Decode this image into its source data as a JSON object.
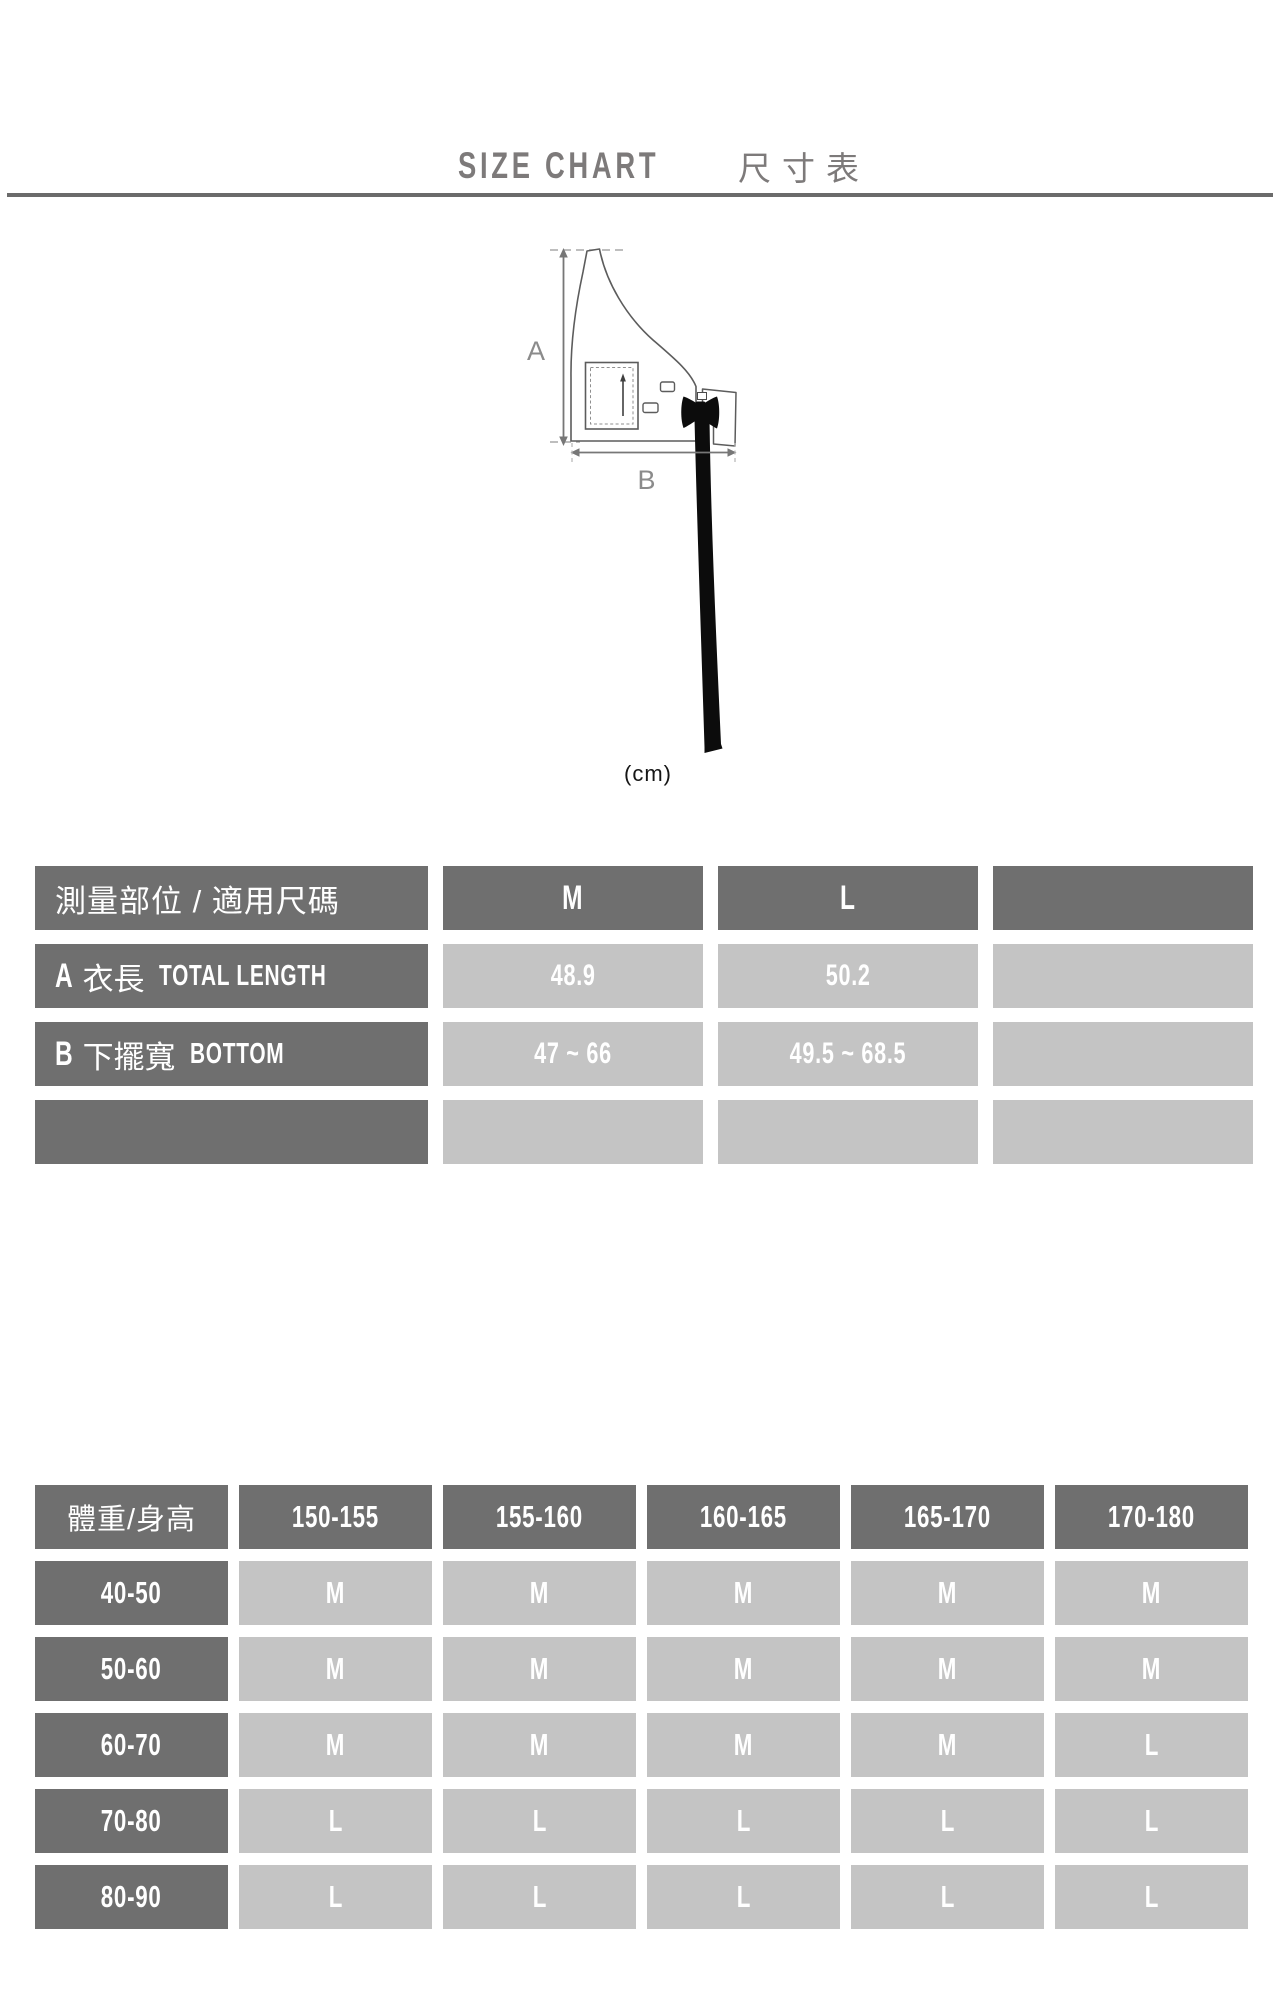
{
  "title": {
    "en": "SIZE CHART",
    "zh": "尺寸表"
  },
  "diagram": {
    "label_a": "A",
    "label_b": "B",
    "unit_note": "(cm)"
  },
  "measure_table": {
    "header": [
      "測量部位 / 適用尺碼",
      "M",
      "L",
      ""
    ],
    "rows": [
      {
        "label_prefix": "A",
        "label_zh": "衣長",
        "label_en": "TOTAL LENGTH",
        "values": [
          "48.9",
          "50.2",
          ""
        ]
      },
      {
        "label_prefix": "B",
        "label_zh": "下擺寬",
        "label_en": "BOTTOM",
        "values": [
          "47 ~ 66",
          "49.5 ~ 68.5",
          ""
        ]
      },
      {
        "label_prefix": "",
        "label_zh": "",
        "label_en": "",
        "values": [
          "",
          "",
          ""
        ]
      }
    ]
  },
  "size_matrix": {
    "header": [
      "體重/身高",
      "150-155",
      "155-160",
      "160-165",
      "165-170",
      "170-180"
    ],
    "rows": [
      {
        "label": "40-50",
        "values": [
          "M",
          "M",
          "M",
          "M",
          "M"
        ]
      },
      {
        "label": "50-60",
        "values": [
          "M",
          "M",
          "M",
          "M",
          "M"
        ]
      },
      {
        "label": "60-70",
        "values": [
          "M",
          "M",
          "M",
          "M",
          "L"
        ]
      },
      {
        "label": "70-80",
        "values": [
          "L",
          "L",
          "L",
          "L",
          "L"
        ]
      },
      {
        "label": "80-90",
        "values": [
          "L",
          "L",
          "L",
          "L",
          "L"
        ]
      }
    ]
  },
  "colors": {
    "dark_cell": "#6f6f6f",
    "light_cell": "#c4c4c4",
    "cell_text": "#ffffff",
    "title_text": "#7d7a7a",
    "divider": "#6b6b6b",
    "diagram_line": "#5c5c5c",
    "strap_black": "#0c0c0c"
  }
}
